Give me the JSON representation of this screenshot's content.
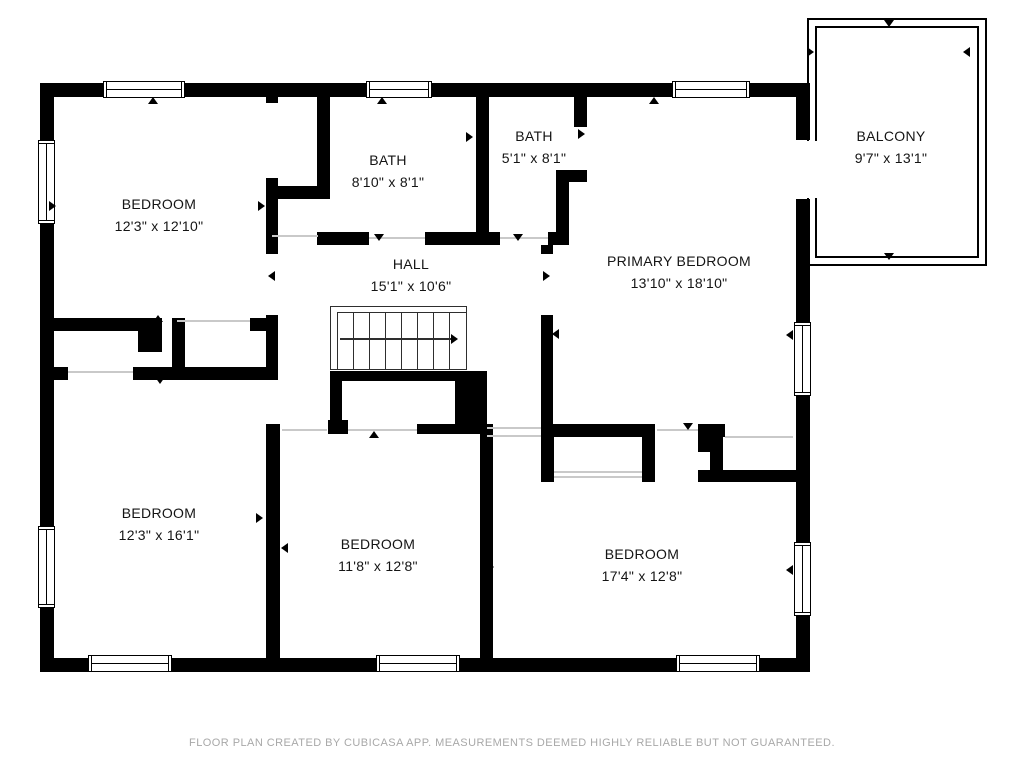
{
  "plan": {
    "footer": "FLOOR PLAN CREATED BY CUBICASA APP. MEASUREMENTS DEEMED HIGHLY RELIABLE BUT NOT GUARANTEED.",
    "colors": {
      "wall": "#000000",
      "label": "#141414",
      "footer": "#a8a8a8",
      "opening": "#c9c9c9",
      "stairs": "#2e2e2e"
    },
    "rooms": [
      {
        "id": "bedroom-top-left",
        "name": "BEDROOM",
        "dims": "12'3\" x 12'10\""
      },
      {
        "id": "bath-1",
        "name": "BATH",
        "dims": "8'10\" x 8'1\""
      },
      {
        "id": "bath-2",
        "name": "BATH",
        "dims": "5'1\" x 8'1\""
      },
      {
        "id": "balcony",
        "name": "BALCONY",
        "dims": "9'7\" x 13'1\""
      },
      {
        "id": "primary-bedroom",
        "name": "PRIMARY BEDROOM",
        "dims": "13'10\" x 18'10\""
      },
      {
        "id": "hall",
        "name": "HALL",
        "dims": "15'1\" x 10'6\""
      },
      {
        "id": "bedroom-bottom-left",
        "name": "BEDROOM",
        "dims": "12'3\" x 16'1\""
      },
      {
        "id": "bedroom-bottom-middle",
        "name": "BEDROOM",
        "dims": "11'8\" x 12'8\""
      },
      {
        "id": "bedroom-bottom-right",
        "name": "BEDROOM",
        "dims": "17'4\" x 12'8\""
      }
    ]
  }
}
